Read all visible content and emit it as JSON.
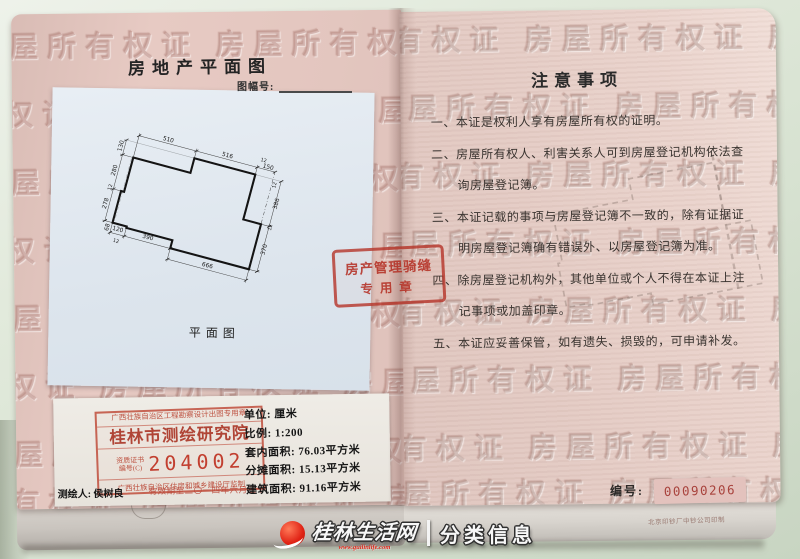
{
  "watermark": {
    "text": "房屋所有权证 房屋所有权证 房屋所有权证 房屋所有权证"
  },
  "left_page": {
    "title": "房地产平面图",
    "map_sheet_label": "图幅号:",
    "plan": {
      "caption": "平面图",
      "dims_top": [
        "510",
        "516",
        "12",
        "150"
      ],
      "dims_left": [
        "130",
        "280",
        "12",
        "278",
        "68"
      ],
      "dims_bottom": [
        "120",
        "390",
        "12",
        "666"
      ],
      "dims_right": [
        "386",
        "12",
        "370",
        "12"
      ]
    },
    "seal_box": {
      "header": "广西壮族自治区工程勘察设计出图专用章",
      "institute": "桂林市测绘研究院",
      "cert_label_line1": "资质证书",
      "cert_label_line2": "编号(C)",
      "cert_number": "204002",
      "footer": "广西壮族自治区住房和城乡建设厅监制"
    },
    "info": {
      "unit": "单位: 厘米",
      "scale": "比例: 1:200",
      "inner_area": "套内面积: 76.03平方米",
      "shared_area": "分摊面积: 15.13平方米",
      "building_area": "建筑面积: 91.16平方米",
      "surveyor": "测绘人: 侯树良",
      "valid_until": "有效期至二〇一四年六月三十"
    },
    "cross_seal": {
      "line1": "房产管理骑缝",
      "line2": "专用章"
    }
  },
  "right_page": {
    "title": "注意事项",
    "items": [
      "一、本证是权利人享有房屋所有权的证明。",
      "二、房屋所有权人、利害关系人可到房屋登记机构依法查",
      "询房屋登记簿。",
      "三、本证记载的事项与房屋登记簿不一致的，除有证据证",
      "明房屋登记簿确有错误外、以房屋登记簿为准。",
      "四、除房屋登记机构外，其他单位或个人不得在本证上注",
      "记事项或加盖印章。",
      "五、本证应妥善保管，如有遗失、损毁的，可申请补发。"
    ],
    "serial_label": "编号:",
    "serial_number": "00090206",
    "printer_note": "北京印钞厂中钞公司印制"
  },
  "photo_watermark": {
    "site_name": "桂林生活网",
    "site_url": "www.guilinlife.com",
    "tagline": "分类信息"
  },
  "colors": {
    "page_pink": "#e4c7c0",
    "stamp_red": "#b8462f",
    "serial_red": "#a8423c",
    "table_green": "#dce6d4"
  }
}
